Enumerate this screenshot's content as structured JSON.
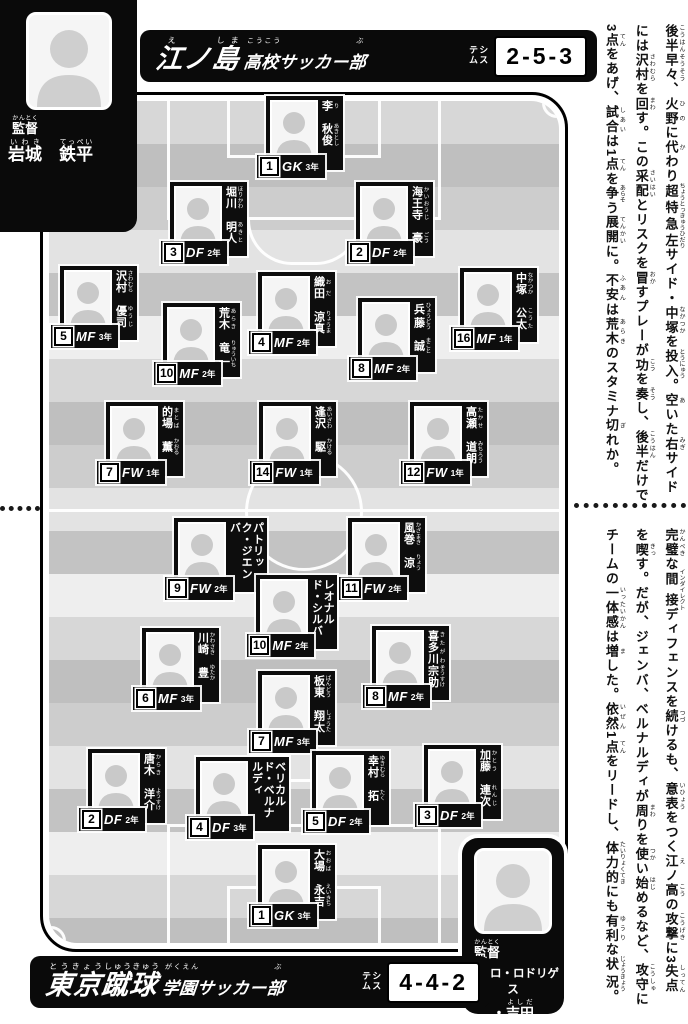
{
  "colors": {
    "panel_bg": "#0a0a0a",
    "card_bg": "#0d0d0d",
    "field_line": "#ffffff",
    "banner_text": "#ffffff",
    "system_value_text": "#000000"
  },
  "coach_top": {
    "role_segments": [
      [
        "監督",
        "かんとく"
      ]
    ],
    "name_segments": [
      [
        "岩城",
        "いわき"
      ],
      [
        "　",
        null
      ],
      [
        "鉄平",
        "てっぺい"
      ]
    ]
  },
  "coach_bottom": {
    "role_segments": [
      [
        "監督",
        "かんとく"
      ]
    ],
    "name_line1": "ペドロ・ロドリゲス",
    "name_line2_segments": [
      [
        "・",
        null
      ],
      [
        "吉田",
        "よしだ"
      ]
    ]
  },
  "top_banner": {
    "main_segments": [
      [
        "江",
        "え"
      ],
      [
        "ノ",
        null
      ],
      [
        "島",
        "しま"
      ]
    ],
    "sub_segments": [
      [
        "高校",
        "こうこう"
      ],
      [
        "サッカー",
        null
      ],
      [
        "部",
        "ぶ"
      ]
    ],
    "system_label": "システム",
    "system_value": "2-5-3"
  },
  "bottom_banner": {
    "main_segments": [
      [
        "東京",
        "とうきょう"
      ],
      [
        "蹴球",
        "しゅうきゅう"
      ]
    ],
    "sub_segments": [
      [
        "学園",
        "がくえん"
      ],
      [
        "サッカー",
        null
      ],
      [
        "部",
        "ぶ"
      ]
    ],
    "system_label": "システム",
    "system_value": "4-4-2"
  },
  "teams": {
    "top": {
      "players": [
        {
          "number": "1",
          "pos": "GK",
          "year": "3年",
          "name_segments": [
            [
              "李",
              "り"
            ],
            [
              "　",
              null
            ],
            [
              "秋俊",
              "あきとし"
            ]
          ],
          "x": 266,
          "y": 96
        },
        {
          "number": "3",
          "pos": "DF",
          "year": "2年",
          "name_segments": [
            [
              "堀川",
              "ほりかわ"
            ],
            [
              "　",
              null
            ],
            [
              "明人",
              "あきと"
            ]
          ],
          "x": 170,
          "y": 182
        },
        {
          "number": "2",
          "pos": "DF",
          "year": "2年",
          "name_segments": [
            [
              "海王寺",
              "かいおうじ"
            ],
            [
              "　",
              null
            ],
            [
              "豪",
              "ごう"
            ]
          ],
          "x": 356,
          "y": 182
        },
        {
          "number": "5",
          "pos": "MF",
          "year": "3年",
          "name_segments": [
            [
              "沢村",
              "さわむら"
            ],
            [
              "　",
              null
            ],
            [
              "優司",
              "ゆうじ"
            ]
          ],
          "x": 60,
          "y": 266
        },
        {
          "number": "4",
          "pos": "MF",
          "year": "2年",
          "name_segments": [
            [
              "織田",
              "おだ"
            ],
            [
              "　",
              null
            ],
            [
              "涼真",
              "りょうま"
            ]
          ],
          "x": 258,
          "y": 272
        },
        {
          "number": "10",
          "pos": "MF",
          "year": "2年",
          "name_segments": [
            [
              "荒木",
              "あらき"
            ],
            [
              "　",
              null
            ],
            [
              "竜一",
              "りゅういち"
            ]
          ],
          "x": 163,
          "y": 303
        },
        {
          "number": "8",
          "pos": "MF",
          "year": "2年",
          "name_segments": [
            [
              "兵藤",
              "ひょうどう"
            ],
            [
              "　",
              null
            ],
            [
              "誠",
              "まこと"
            ]
          ],
          "x": 358,
          "y": 298
        },
        {
          "number": "16",
          "pos": "MF",
          "year": "1年",
          "name_segments": [
            [
              "中塚",
              "なかつか"
            ],
            [
              "　",
              null
            ],
            [
              "公太",
              "こうた"
            ]
          ],
          "x": 460,
          "y": 268
        },
        {
          "number": "7",
          "pos": "FW",
          "year": "1年",
          "name_segments": [
            [
              "的場",
              "まとば"
            ],
            [
              "　",
              null
            ],
            [
              "薫",
              "かおる"
            ]
          ],
          "x": 106,
          "y": 402
        },
        {
          "number": "14",
          "pos": "FW",
          "year": "1年",
          "name_segments": [
            [
              "逢沢",
              "あいざわ"
            ],
            [
              "　",
              null
            ],
            [
              "駆",
              "かける"
            ]
          ],
          "x": 259,
          "y": 402
        },
        {
          "number": "12",
          "pos": "FW",
          "year": "1年",
          "name_segments": [
            [
              "高瀬",
              "たかせ"
            ],
            [
              "　",
              null
            ],
            [
              "道朗",
              "みちろう"
            ]
          ],
          "x": 410,
          "y": 402
        }
      ]
    },
    "bottom": {
      "players": [
        {
          "number": "9",
          "pos": "FW",
          "year": "2年",
          "name_segments": [
            [
              "パトリック・",
              null
            ],
            [
              "ジエンバ",
              null
            ]
          ],
          "x": 174,
          "y": 518
        },
        {
          "number": "11",
          "pos": "FW",
          "year": "2年",
          "name_segments": [
            [
              "風巻",
              "かざまき"
            ],
            [
              "　",
              null
            ],
            [
              "涼",
              "りょう"
            ]
          ],
          "x": 348,
          "y": 518
        },
        {
          "number": "10",
          "pos": "MF",
          "year": "2年",
          "name_segments": [
            [
              "レオナルド・",
              null
            ],
            [
              "シルバ",
              null
            ]
          ],
          "x": 256,
          "y": 575
        },
        {
          "number": "6",
          "pos": "MF",
          "year": "3年",
          "name_segments": [
            [
              "川崎",
              "かわさき"
            ],
            [
              "　",
              null
            ],
            [
              "豊",
              "ゆたか"
            ]
          ],
          "x": 142,
          "y": 628
        },
        {
          "number": "8",
          "pos": "MF",
          "year": "2年",
          "name_segments": [
            [
              "喜多川",
              "きたがわ"
            ],
            [
              "宗助",
              "そうすけ"
            ]
          ],
          "x": 372,
          "y": 626
        },
        {
          "number": "7",
          "pos": "MF",
          "year": "3年",
          "name_segments": [
            [
              "板東",
              "ばんどう"
            ],
            [
              "　",
              null
            ],
            [
              "翔太",
              "しょうた"
            ]
          ],
          "x": 258,
          "y": 671
        },
        {
          "number": "2",
          "pos": "DF",
          "year": "2年",
          "name_segments": [
            [
              "唐木",
              "からき"
            ],
            [
              "　",
              null
            ],
            [
              "洋介",
              "ようすけ"
            ]
          ],
          "x": 88,
          "y": 749
        },
        {
          "number": "4",
          "pos": "DF",
          "year": "3年",
          "name_segments": [
            [
              "ベリカルド・",
              null
            ],
            [
              "ベルナルディ",
              null
            ]
          ],
          "x": 196,
          "y": 757
        },
        {
          "number": "5",
          "pos": "DF",
          "year": "2年",
          "name_segments": [
            [
              "幸村",
              "ゆきむら"
            ],
            [
              "　",
              null
            ],
            [
              "拓",
              "たく"
            ]
          ],
          "x": 312,
          "y": 751
        },
        {
          "number": "3",
          "pos": "DF",
          "year": "2年",
          "name_segments": [
            [
              "加藤",
              "かとう"
            ],
            [
              "　",
              null
            ],
            [
              "連次",
              "れんじ"
            ]
          ],
          "x": 424,
          "y": 745
        },
        {
          "number": "1",
          "pos": "GK",
          "year": "3年",
          "name_segments": [
            [
              "大場",
              "おおば"
            ],
            [
              "　",
              null
            ],
            [
              "永吉",
              "えいきち"
            ]
          ],
          "x": 258,
          "y": 845
        }
      ]
    }
  },
  "commentary_top": {
    "columns": [
      [
        [
          "後半早々",
          "こうはんそうそう"
        ],
        [
          "、",
          null
        ],
        [
          "火野",
          "ひの"
        ],
        [
          "に",
          null
        ],
        [
          "代",
          "か"
        ],
        [
          "わり",
          null
        ],
        [
          "超特急左",
          "ちょうとっきゅうひだり"
        ],
        [
          "サイド・",
          null
        ],
        [
          "中塚",
          "なかつか"
        ],
        [
          "を",
          null
        ],
        [
          "投入",
          "とうにゅう"
        ],
        [
          "。",
          null
        ],
        [
          "空",
          "あ"
        ],
        [
          "いた",
          null
        ],
        [
          "右",
          "みぎ"
        ],
        [
          "サイド",
          null
        ]
      ],
      [
        [
          "には",
          null
        ],
        [
          "沢村",
          "さわむら"
        ],
        [
          "を",
          null
        ],
        [
          "回",
          "まわ"
        ],
        [
          "す。この",
          null
        ],
        [
          "采配",
          "さいはい"
        ],
        [
          "とリスクを",
          null
        ],
        [
          "冒",
          "おか"
        ],
        [
          "すプレーが",
          null
        ],
        [
          "功",
          "こう"
        ],
        [
          "を",
          null
        ],
        [
          "奏",
          "そう"
        ],
        [
          "し、",
          null
        ],
        [
          "後半",
          "こうはん"
        ],
        [
          "だけで",
          null
        ]
      ],
      [
        [
          "3",
          null
        ],
        [
          "点",
          "てん"
        ],
        [
          "をあげ、",
          null
        ],
        [
          "試合",
          "しあい"
        ],
        [
          "は1",
          null
        ],
        [
          "点",
          "てん"
        ],
        [
          "を",
          null
        ],
        [
          "争",
          "あらそ"
        ],
        [
          "う",
          null
        ],
        [
          "展開",
          "てんかい"
        ],
        [
          "に。",
          null
        ],
        [
          "不安",
          "ふあん"
        ],
        [
          "は",
          null
        ],
        [
          "荒木",
          "あらき"
        ],
        [
          "のスタミナ",
          null
        ],
        [
          "切",
          "ぎ"
        ],
        [
          "れか。",
          null
        ]
      ]
    ]
  },
  "commentary_bottom": {
    "columns": [
      [
        [
          "完璧",
          "かんぺき"
        ],
        [
          "な",
          null
        ],
        [
          "間接",
          "インダイレクト"
        ],
        [
          "ディフェンスを",
          null
        ],
        [
          "続",
          "つづ"
        ],
        [
          "けるも、",
          null
        ],
        [
          "意表",
          "いひょう"
        ],
        [
          "をつく",
          null
        ],
        [
          "江",
          "え"
        ],
        [
          "ノ",
          null
        ],
        [
          "高",
          "こう"
        ],
        [
          "の",
          null
        ],
        [
          "攻撃",
          "こうげき"
        ],
        [
          "に3",
          null
        ],
        [
          "失点",
          "しってん"
        ]
      ],
      [
        [
          "を",
          null
        ],
        [
          "喫",
          "きっ"
        ],
        [
          "す。だが、ジェンバ、ベルナルディが",
          null
        ],
        [
          "周",
          "まわ"
        ],
        [
          "りを",
          null
        ],
        [
          "使",
          "つか"
        ],
        [
          "い",
          null
        ],
        [
          "始",
          "はじ"
        ],
        [
          "めるなど、",
          null
        ],
        [
          "攻守",
          "こうしゅ"
        ],
        [
          "に",
          null
        ]
      ],
      [
        [
          "チームの",
          null
        ],
        [
          "一体感",
          "いったいかん"
        ],
        [
          "は",
          null
        ],
        [
          "増",
          "ま"
        ],
        [
          "した。",
          null
        ],
        [
          "依然",
          "いぜん"
        ],
        [
          "1",
          null
        ],
        [
          "点",
          "てん"
        ],
        [
          "をリードし、",
          null
        ],
        [
          "体力的",
          "たいりょくてき"
        ],
        [
          "にも",
          null
        ],
        [
          "有利",
          "ゆうり"
        ],
        [
          "な",
          null
        ],
        [
          "状況",
          "じょうきょう"
        ],
        [
          "。",
          null
        ]
      ]
    ]
  }
}
